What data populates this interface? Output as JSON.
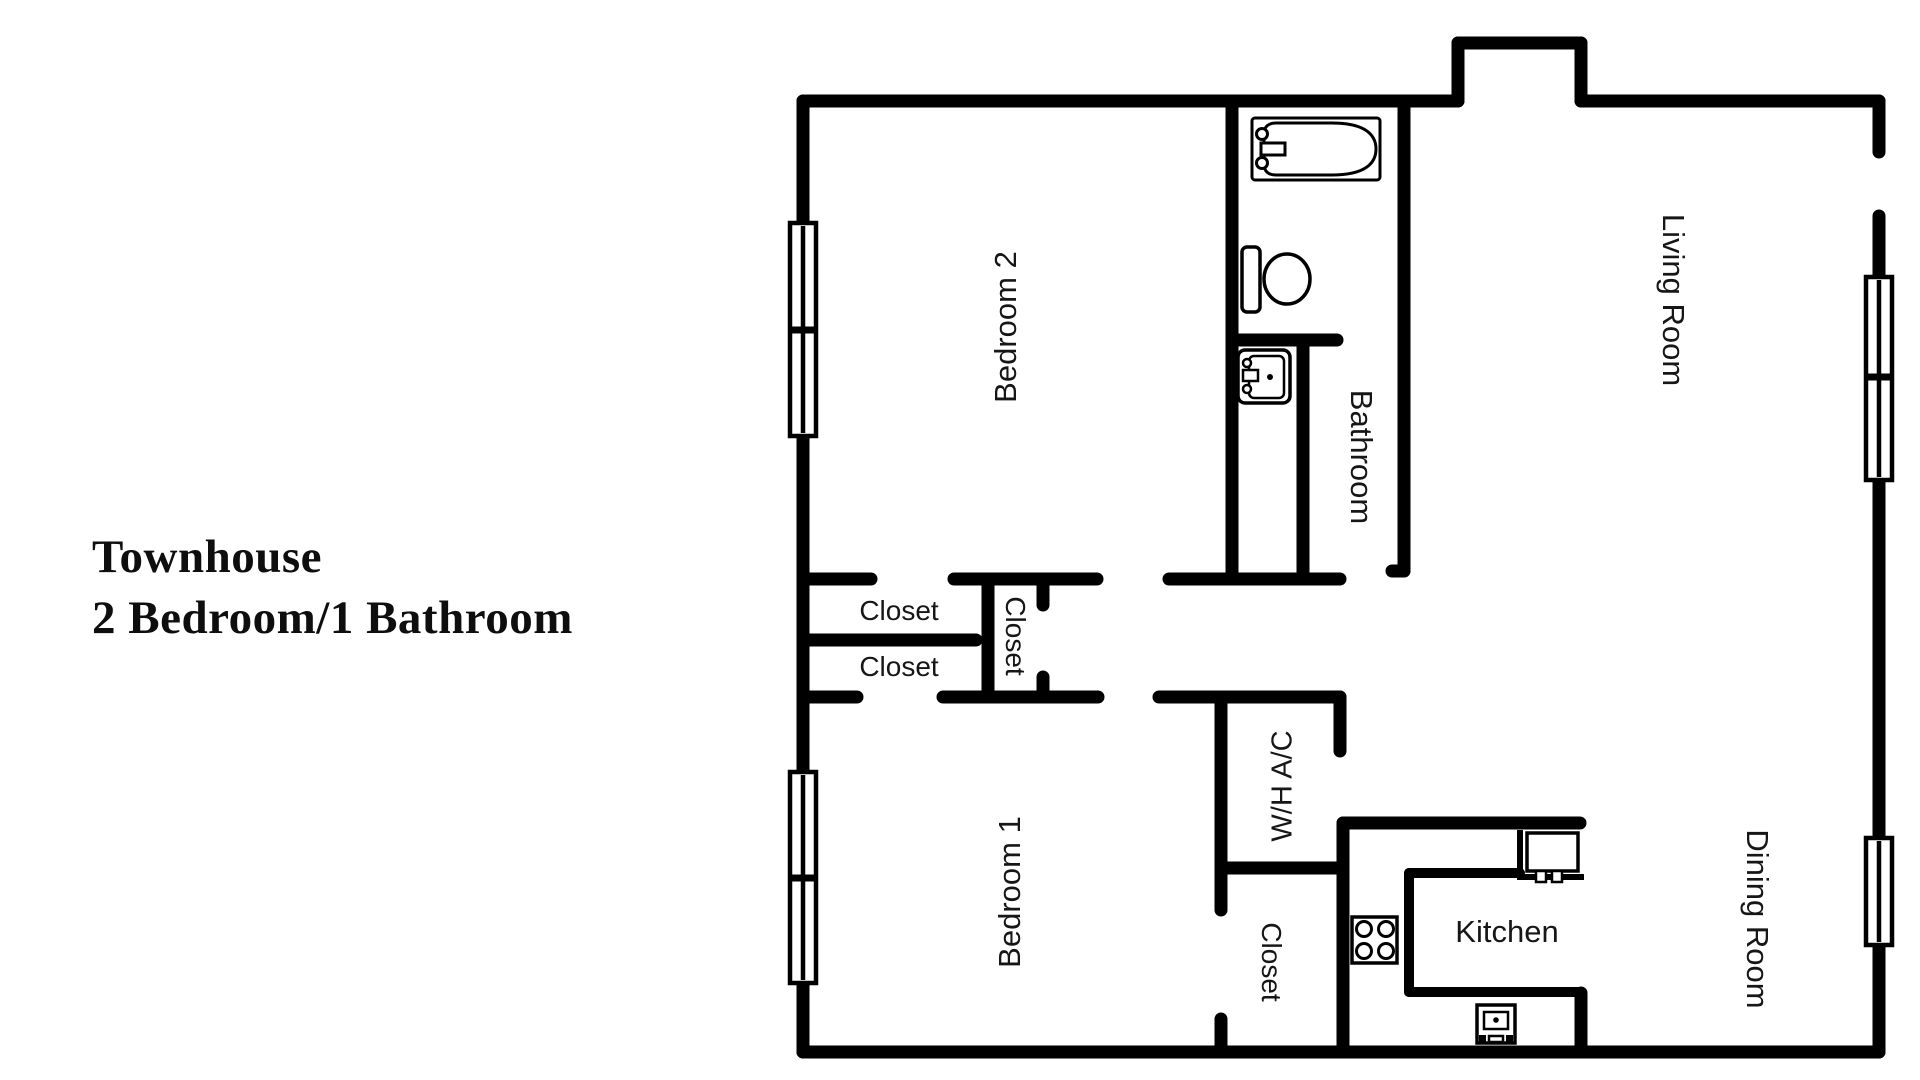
{
  "title": {
    "line1": "Townhouse",
    "line2": "2 Bedroom/1 Bathroom"
  },
  "floor_plan": {
    "rooms": [
      {
        "id": "bedroom-2",
        "label": "Bedroom 2",
        "orientation": "vertical-up"
      },
      {
        "id": "bathroom",
        "label": "Bathroom",
        "orientation": "vertical-down"
      },
      {
        "id": "living-room",
        "label": "Living Room",
        "orientation": "vertical-down"
      },
      {
        "id": "closet-bedroom-2",
        "label": "Closet",
        "orientation": "horizontal"
      },
      {
        "id": "closet-bedroom-1",
        "label": "Closet",
        "orientation": "horizontal"
      },
      {
        "id": "closet-hallway",
        "label": "Closet",
        "orientation": "vertical-down"
      },
      {
        "id": "utility-closet",
        "label": "W/H A/C",
        "orientation": "vertical-up"
      },
      {
        "id": "bedroom-1",
        "label": "Bedroom 1",
        "orientation": "vertical-up"
      },
      {
        "id": "closet-kitchen",
        "label": "Closet",
        "orientation": "vertical-down"
      },
      {
        "id": "kitchen",
        "label": "Kitchen",
        "orientation": "horizontal"
      },
      {
        "id": "dining-room",
        "label": "Dining Room",
        "orientation": "vertical-down"
      }
    ],
    "fixtures": [
      {
        "icon": "bathtub-icon"
      },
      {
        "icon": "toilet-icon"
      },
      {
        "icon": "bathroom-sink-icon"
      },
      {
        "icon": "stove-icon"
      },
      {
        "icon": "kitchen-sink-icon"
      },
      {
        "icon": "oven-icon"
      }
    ],
    "windows": 4,
    "colors": {
      "walls": "#000000",
      "background": "#ffffff",
      "text": "#161616"
    }
  }
}
